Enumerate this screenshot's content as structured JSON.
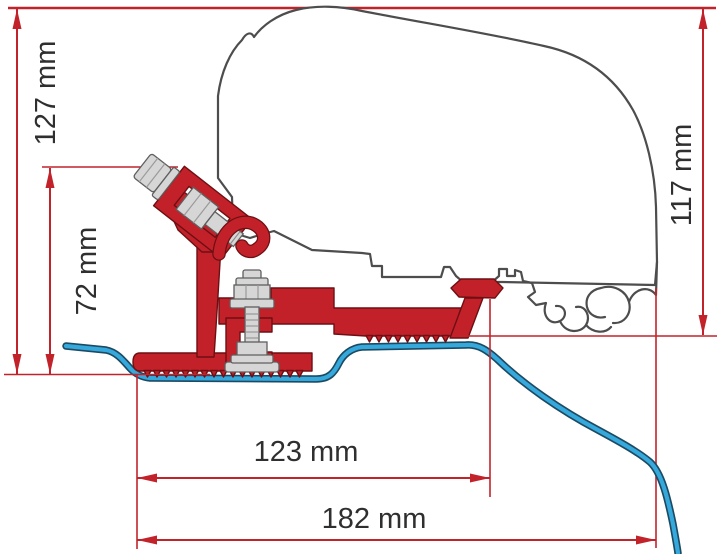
{
  "diagram": {
    "kind": "technical-dimension-drawing",
    "dimensions": {
      "d127": {
        "label": "127 mm",
        "value_mm": 127,
        "orientation": "vertical"
      },
      "d72": {
        "label": "72 mm",
        "value_mm": 72,
        "orientation": "vertical"
      },
      "d117": {
        "label": "117 mm",
        "value_mm": 117,
        "orientation": "vertical"
      },
      "d123": {
        "label": "123 mm",
        "value_mm": 123,
        "orientation": "horizontal"
      },
      "d182": {
        "label": "182 mm",
        "value_mm": 182,
        "orientation": "horizontal"
      }
    },
    "parts": {
      "vehicle_outline": "van roof cross-section outline",
      "rail_profile": "awning rail profile",
      "roof_profile": "roof sheet profile line",
      "bracket": "red adapter bracket",
      "clamp_bolt": "angled clamp bolt assembly",
      "mounting_bolt": "vertical mounting bolt assembly"
    },
    "colors": {
      "dimension_line": "#c2232b",
      "bracket_red": "#c32129",
      "roof_profile_blue": "#35a8dc",
      "roof_profile_outline": "#1d4a63",
      "vehicle_outline": "#4d4d4d",
      "hardware_gray": "#d6d6d6",
      "label_text": "#2f2f2f"
    }
  }
}
